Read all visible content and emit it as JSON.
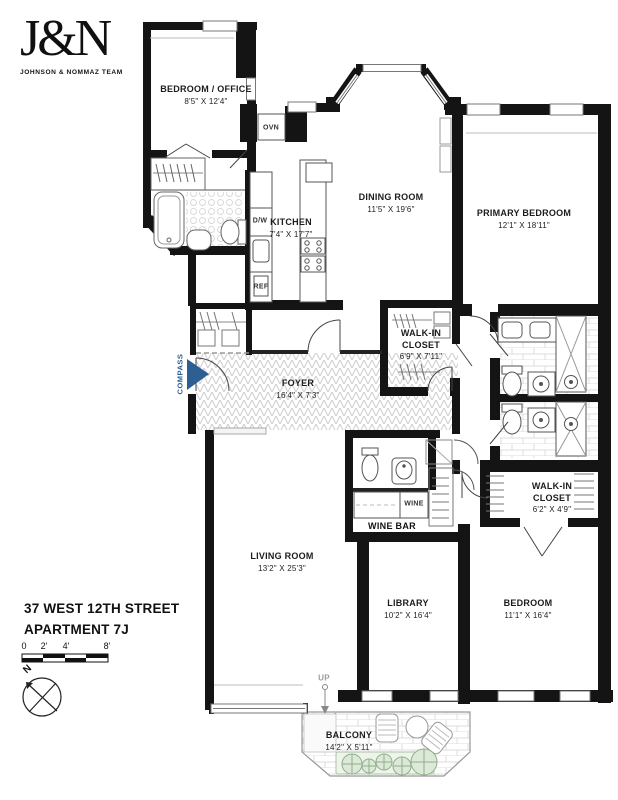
{
  "logo": {
    "mark": "J&N",
    "tagline": "JOHNSON & NOMMAZ TEAM"
  },
  "address": {
    "line1": "37 WEST 12TH STREET",
    "line2": "APARTMENT 7J"
  },
  "scale_bar": {
    "ticks": [
      "0",
      "2'",
      "4'",
      "8'"
    ]
  },
  "compass": {
    "north_label": "N",
    "brand_label": "COMPASS",
    "brand_color": "#2d5f94"
  },
  "rooms": [
    {
      "name": "BEDROOM / OFFICE",
      "dims": "8'5\" X 12'4\""
    },
    {
      "name": "KITCHEN",
      "dims": "7'4\" X 17'7\""
    },
    {
      "name": "DINING ROOM",
      "dims": "11'5\" X 19'6\""
    },
    {
      "name": "PRIMARY BEDROOM",
      "dims": "12'1\" X 18'11\""
    },
    {
      "name": "WALK-IN CLOSET",
      "dims": "6'9\" X 7'11\""
    },
    {
      "name": "FOYER",
      "dims": "16'4\" X 7'3\""
    },
    {
      "name": "WALK-IN CLOSET",
      "dims": "6'2\" X 4'9\""
    },
    {
      "name": "LIVING ROOM",
      "dims": "13'2\" X 25'3\""
    },
    {
      "name": "LIBRARY",
      "dims": "10'2\" X 16'4\""
    },
    {
      "name": "BEDROOM",
      "dims": "11'1\" X 16'4\""
    },
    {
      "name": "BALCONY",
      "dims": "14'2\" X 5'11\""
    }
  ],
  "labels": {
    "oven": "OVN",
    "dishwasher": "D/W",
    "refrigerator": "REF",
    "wine": "WINE",
    "wine_bar": "WINE BAR",
    "up": "UP"
  }
}
